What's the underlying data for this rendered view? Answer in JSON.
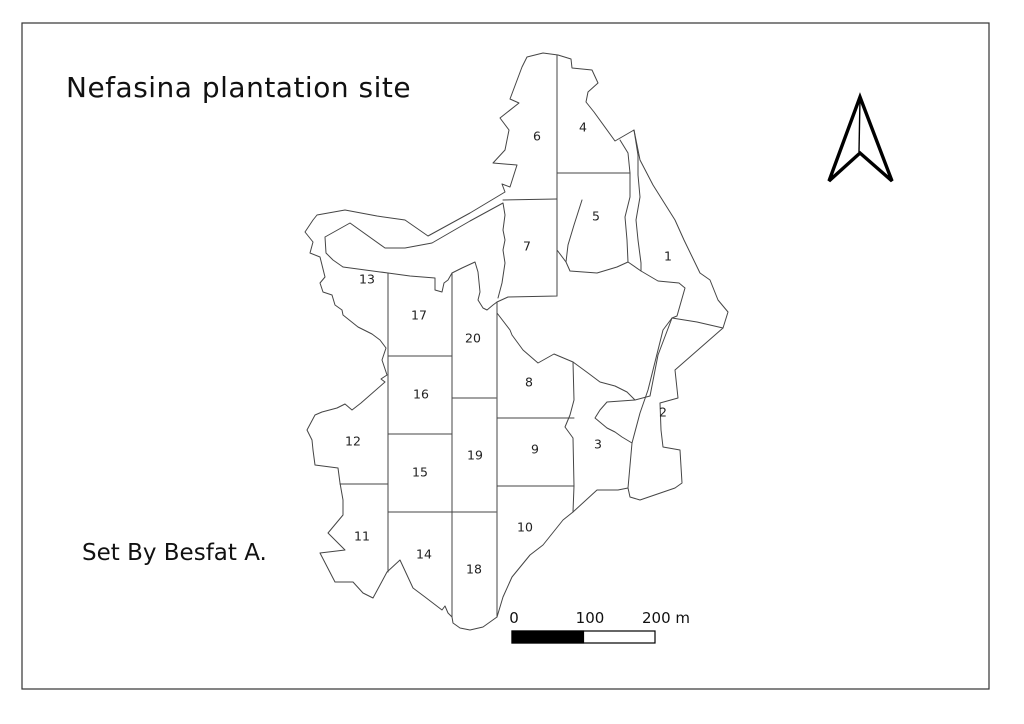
{
  "page": {
    "background": "#ffffff",
    "border_color": "#333333"
  },
  "map": {
    "title": "Nefasina plantation site",
    "credit": "Set By  Besfat A.",
    "line_color": "#454545",
    "plots": [
      {
        "id": "1",
        "x": 668,
        "y": 257
      },
      {
        "id": "2",
        "x": 663,
        "y": 413
      },
      {
        "id": "3",
        "x": 598,
        "y": 445
      },
      {
        "id": "4",
        "x": 583,
        "y": 128
      },
      {
        "id": "5",
        "x": 596,
        "y": 217
      },
      {
        "id": "6",
        "x": 537,
        "y": 137
      },
      {
        "id": "7",
        "x": 527,
        "y": 247
      },
      {
        "id": "8",
        "x": 529,
        "y": 383
      },
      {
        "id": "9",
        "x": 535,
        "y": 450
      },
      {
        "id": "10",
        "x": 525,
        "y": 528
      },
      {
        "id": "11",
        "x": 362,
        "y": 537
      },
      {
        "id": "12",
        "x": 353,
        "y": 442
      },
      {
        "id": "13",
        "x": 367,
        "y": 280
      },
      {
        "id": "14",
        "x": 424,
        "y": 555
      },
      {
        "id": "15",
        "x": 420,
        "y": 473
      },
      {
        "id": "16",
        "x": 421,
        "y": 395
      },
      {
        "id": "17",
        "x": 419,
        "y": 316
      },
      {
        "id": "18",
        "x": 474,
        "y": 570
      },
      {
        "id": "19",
        "x": 475,
        "y": 456
      },
      {
        "id": "20",
        "x": 473,
        "y": 339
      }
    ],
    "scale_bar": {
      "tick_labels": {
        "zero": "0",
        "mid": "100",
        "end": "200 m"
      },
      "fill_color": "#000000"
    },
    "north_arrow": {
      "color": "#000000"
    }
  }
}
